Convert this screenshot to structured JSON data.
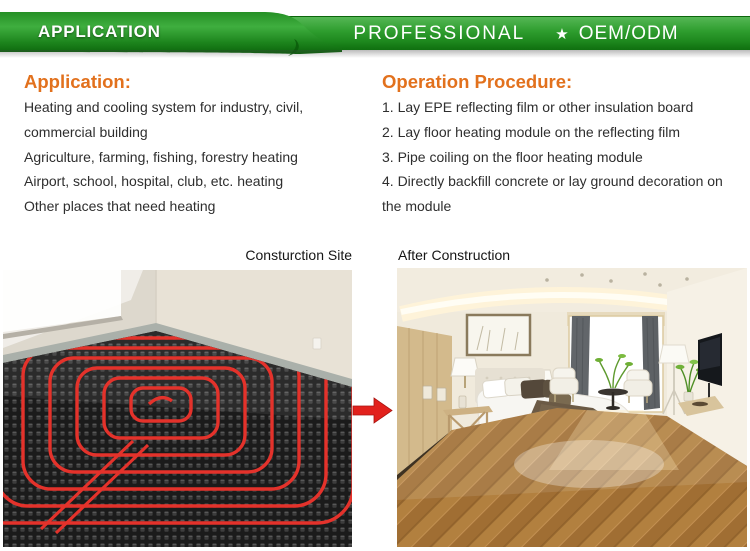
{
  "banner": {
    "tab_label": "APPLICATION",
    "main_label": "PROFESSIONAL",
    "star": "★",
    "oem_label": "OEM/ODM"
  },
  "application": {
    "heading": "Application:",
    "lines": [
      "Heating and cooling system for industry, civil, commercial building",
      "Agriculture, farming, fishing, forestry heating",
      "Airport, school, hospital, club, etc. heating",
      "Other places that need heating"
    ]
  },
  "procedure": {
    "heading": "Operation Procedure:",
    "steps": [
      "1. Lay EPE reflecting film or other insulation board",
      "2. Lay floor heating module on the reflecting film",
      "3. Pipe coiling on the floor heating module",
      "4. Directly backfill concrete or lay ground decoration on the module"
    ]
  },
  "captions": {
    "left": "Consturction Site",
    "right": "After Construction"
  },
  "colors": {
    "banner_green_light": "#55b755",
    "banner_green": "#2f9e2f",
    "banner_green_dark": "#0c660c",
    "heading_orange": "#e2711d",
    "arrow_red": "#e2211c",
    "pipe_red": "#e4322b",
    "body_text": "#2e2e2e"
  }
}
